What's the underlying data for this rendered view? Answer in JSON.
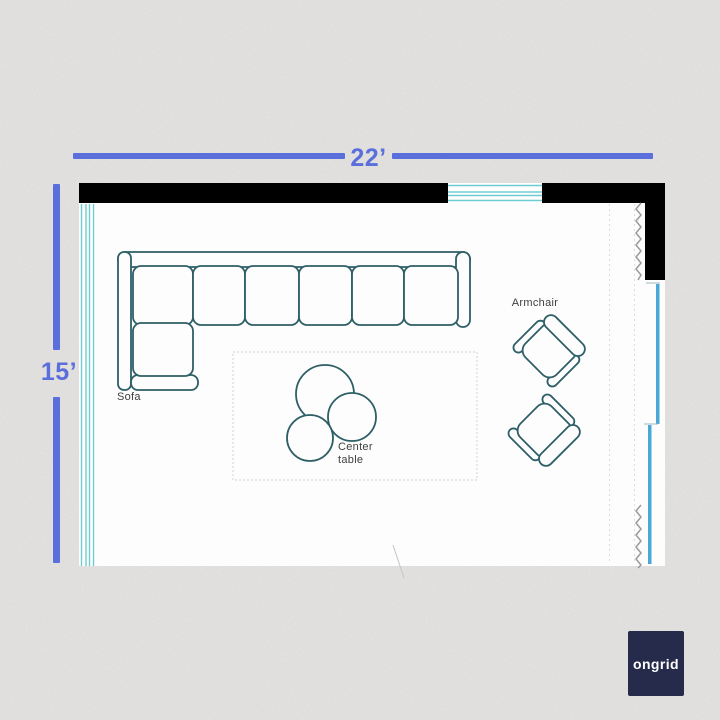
{
  "page": {
    "title": "Living room floor plan"
  },
  "dimensions": {
    "width_label": "22’",
    "height_label": "15’",
    "room_width_ft": 22,
    "room_height_ft": 15
  },
  "labels": {
    "sofa": "Sofa",
    "armchair": "Armchair",
    "center_table_line1": "Center",
    "center_table_line2": "table"
  },
  "furniture_items": [
    "Sofa",
    "Center table",
    "Armchair",
    "Armchair"
  ],
  "logo": {
    "wordmark": "ongrid"
  },
  "colors": {
    "background": "#e4e3e1",
    "room_fill": "#fdfdfd",
    "wall": "#000000",
    "dimension_blue": "#5a6edc",
    "window_teal": "#6ecdd2",
    "sliding_door_blue": "#49a8d8",
    "furniture_outline": "#2e5f66",
    "label_text": "#3f3f3f",
    "logo_background": "#262a4b",
    "logo_text": "#ffffff"
  }
}
